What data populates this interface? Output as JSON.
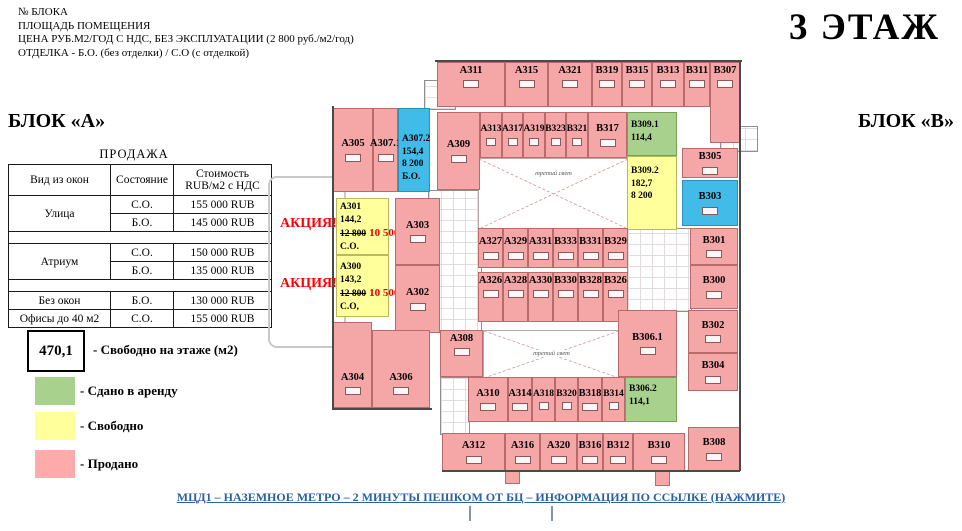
{
  "doc_header": {
    "lines": [
      "№ БЛОКА",
      "ПЛОЩАДЬ ПОМЕЩЕНИЯ",
      "ЦЕНА РУБ.М2/ГОД С НДС, БЕЗ ЭКСПЛУАТАЦИИ (2 800 руб./м2/год)",
      "ОТДЕЛКА - Б.О. (без отделки) / С.О (с отделкой)"
    ]
  },
  "floor_title": "3 ЭТАЖ",
  "block_labels": {
    "a": "БЛОК «А»",
    "b": "БЛОК «В»"
  },
  "sales_table": {
    "title": "ПРОДАЖА",
    "columns": [
      "Вид из окон",
      "Состояние",
      "Стоимость\nRUB/м2 с НДС"
    ],
    "groups": [
      {
        "name": "Улица",
        "rows": [
          [
            "С.О.",
            "155 000 RUB"
          ],
          [
            "Б.О.",
            "145 000 RUB"
          ]
        ],
        "spacer_after": true
      },
      {
        "name": "Атриум",
        "rows": [
          [
            "С.О.",
            "150 000 RUB"
          ],
          [
            "Б.О.",
            "135 000 RUB"
          ]
        ],
        "spacer_after": true
      },
      {
        "name": "Без окон",
        "rows": [
          [
            "Б.О.",
            "130 000 RUB"
          ]
        ],
        "spacer_after": false
      },
      {
        "name": "Офисы до 40 м2",
        "rows": [
          [
            "С.О.",
            "155 000 RUB"
          ]
        ],
        "spacer_after": false
      }
    ]
  },
  "legend": {
    "free_area_box": {
      "value": "470,1",
      "label": "- Свободно на этаже (м2)"
    },
    "items": [
      {
        "key": "leased",
        "color": "#A9D18E",
        "label": "- Сдано в аренду"
      },
      {
        "key": "free",
        "color": "#FFFF9C",
        "label": "- Свободно"
      },
      {
        "key": "sold",
        "color": "#FFABAB",
        "label": "- Продано"
      }
    ]
  },
  "promo_labels": [
    {
      "text": "АКЦИЯ!",
      "x": 280,
      "y": 216
    },
    {
      "text": "АКЦИЯ!",
      "x": 280,
      "y": 276
    }
  ],
  "colors": {
    "sold": {
      "fill": "#F5A6A6",
      "border": "#B96A6A"
    },
    "free": {
      "fill": "#FFFF9C",
      "border": "#B9B95E"
    },
    "leased": {
      "fill": "#A9D18E",
      "border": "#74A356"
    },
    "special": {
      "fill": "#41BCE8",
      "border": "#2E8FB5"
    }
  },
  "plan": {
    "atrium_label": "третий свет",
    "atriums": [
      {
        "r": [
          478,
          158,
          149,
          70
        ],
        "label_pos": 0.16
      },
      {
        "r": [
          483,
          330,
          135,
          47
        ],
        "label_pos": 0.4
      }
    ],
    "cores": [
      [
        428,
        190,
        52,
        140
      ],
      [
        440,
        377,
        28,
        56
      ],
      [
        627,
        228,
        63,
        82
      ],
      [
        720,
        126,
        36,
        24
      ],
      [
        424,
        80,
        30,
        28
      ]
    ],
    "stubs": [
      [
        505,
        470,
        13,
        12
      ],
      [
        655,
        470,
        13,
        14
      ]
    ],
    "rooms": [
      {
        "id": "А311",
        "s": "sold",
        "r": [
          437,
          62,
          68,
          45
        ],
        "va": "top"
      },
      {
        "id": "А315",
        "s": "sold",
        "r": [
          505,
          62,
          43,
          45
        ],
        "va": "top"
      },
      {
        "id": "А321",
        "s": "sold",
        "r": [
          548,
          62,
          44,
          45
        ],
        "va": "top"
      },
      {
        "id": "В319",
        "s": "sold",
        "r": [
          592,
          62,
          30,
          45
        ],
        "va": "top"
      },
      {
        "id": "В315",
        "s": "sold",
        "r": [
          622,
          62,
          30,
          45
        ],
        "va": "top"
      },
      {
        "id": "В313",
        "s": "sold",
        "r": [
          652,
          62,
          32,
          45
        ],
        "va": "top"
      },
      {
        "id": "В311",
        "s": "sold",
        "r": [
          684,
          62,
          26,
          45
        ],
        "va": "top"
      },
      {
        "id": "В307",
        "s": "sold",
        "r": [
          710,
          62,
          30,
          81
        ],
        "va": "top"
      },
      {
        "id": "А305",
        "s": "sold",
        "r": [
          333,
          108,
          40,
          84
        ]
      },
      {
        "id": "А307.1",
        "s": "sold",
        "r": [
          373,
          108,
          25,
          84
        ]
      },
      {
        "id": "А307.2",
        "s": "special",
        "r": [
          398,
          108,
          32,
          84
        ],
        "lines": [
          "А307.2",
          "154,4",
          "8 200",
          "Б.О."
        ],
        "pt": 24
      },
      {
        "id": "А309",
        "s": "sold",
        "r": [
          437,
          112,
          43,
          78
        ]
      },
      {
        "id": "А313",
        "s": "sold",
        "r": [
          480,
          112,
          22,
          46
        ]
      },
      {
        "id": "А317",
        "s": "sold",
        "r": [
          502,
          112,
          21,
          46
        ]
      },
      {
        "id": "А319",
        "s": "sold",
        "r": [
          523,
          112,
          22,
          46
        ]
      },
      {
        "id": "В323",
        "s": "sold",
        "r": [
          545,
          112,
          21,
          46
        ]
      },
      {
        "id": "В321",
        "s": "sold",
        "r": [
          566,
          112,
          22,
          46
        ]
      },
      {
        "id": "В317",
        "s": "sold",
        "r": [
          588,
          112,
          39,
          46
        ]
      },
      {
        "id": "В309.1",
        "s": "leased",
        "r": [
          627,
          112,
          50,
          44
        ],
        "lines": [
          "В309.1",
          "114,4"
        ],
        "pt": 6
      },
      {
        "id": "В309.2",
        "s": "free",
        "r": [
          627,
          156,
          50,
          74
        ],
        "lines": [
          "В309.2",
          "182,7",
          "8 200"
        ],
        "pt": 8
      },
      {
        "id": "А301",
        "s": "free",
        "r": [
          336,
          198,
          53,
          57
        ],
        "lines": [
          "А301",
          "144,2",
          {
            "old": "12 800",
            "new": "10 500"
          },
          "С.О."
        ],
        "pt": 2
      },
      {
        "id": "А300",
        "s": "free",
        "r": [
          336,
          255,
          53,
          62
        ],
        "lines": [
          "А300",
          "143,2",
          {
            "old": "12 800",
            "new": "10 500"
          },
          "С.О,"
        ],
        "pt": 5
      },
      {
        "id": "А303",
        "s": "sold",
        "r": [
          395,
          198,
          45,
          67
        ]
      },
      {
        "id": "А302",
        "s": "sold",
        "r": [
          395,
          265,
          45,
          68
        ]
      },
      {
        "id": "А304",
        "s": "sold",
        "r": [
          333,
          322,
          39,
          86
        ],
        "va": "bottom"
      },
      {
        "id": "А306",
        "s": "sold",
        "r": [
          372,
          330,
          58,
          78
        ],
        "va": "bottom"
      },
      {
        "id": "А308",
        "s": "sold",
        "r": [
          440,
          330,
          43,
          47
        ],
        "va": "top"
      },
      {
        "id": "А327",
        "s": "sold",
        "r": [
          478,
          228,
          25,
          40
        ]
      },
      {
        "id": "А329",
        "s": "sold",
        "r": [
          503,
          228,
          25,
          40
        ]
      },
      {
        "id": "А331",
        "s": "sold",
        "r": [
          528,
          228,
          25,
          40
        ]
      },
      {
        "id": "В333",
        "s": "sold",
        "r": [
          553,
          228,
          25,
          40
        ]
      },
      {
        "id": "В331",
        "s": "sold",
        "r": [
          578,
          228,
          25,
          40
        ]
      },
      {
        "id": "В329",
        "s": "sold",
        "r": [
          603,
          228,
          25,
          40
        ]
      },
      {
        "id": "А326",
        "s": "sold",
        "r": [
          478,
          272,
          25,
          50
        ],
        "va": "top"
      },
      {
        "id": "А328",
        "s": "sold",
        "r": [
          503,
          272,
          25,
          50
        ],
        "va": "top"
      },
      {
        "id": "А330",
        "s": "sold",
        "r": [
          528,
          272,
          25,
          50
        ],
        "va": "top"
      },
      {
        "id": "В330",
        "s": "sold",
        "r": [
          553,
          272,
          25,
          50
        ],
        "va": "top"
      },
      {
        "id": "В328",
        "s": "sold",
        "r": [
          578,
          272,
          25,
          50
        ],
        "va": "top"
      },
      {
        "id": "В326",
        "s": "sold",
        "r": [
          603,
          272,
          25,
          50
        ],
        "va": "top"
      },
      {
        "id": "А310",
        "s": "sold",
        "r": [
          468,
          377,
          40,
          45
        ]
      },
      {
        "id": "А314",
        "s": "sold",
        "r": [
          508,
          377,
          24,
          45
        ]
      },
      {
        "id": "А318",
        "s": "sold",
        "r": [
          532,
          377,
          23,
          45
        ]
      },
      {
        "id": "В320",
        "s": "sold",
        "r": [
          555,
          377,
          23,
          45
        ]
      },
      {
        "id": "В318",
        "s": "sold",
        "r": [
          578,
          377,
          24,
          45
        ]
      },
      {
        "id": "В314",
        "s": "sold",
        "r": [
          602,
          377,
          23,
          45
        ]
      },
      {
        "id": "В306.2",
        "s": "leased",
        "r": [
          625,
          377,
          52,
          45
        ],
        "lines": [
          "В306.2",
          "114,1"
        ],
        "pt": 5
      },
      {
        "id": "А312",
        "s": "sold",
        "r": [
          442,
          433,
          63,
          38
        ]
      },
      {
        "id": "А316",
        "s": "sold",
        "r": [
          505,
          433,
          35,
          38
        ]
      },
      {
        "id": "А320",
        "s": "sold",
        "r": [
          540,
          433,
          37,
          38
        ]
      },
      {
        "id": "В316",
        "s": "sold",
        "r": [
          577,
          433,
          26,
          38
        ]
      },
      {
        "id": "В312",
        "s": "sold",
        "r": [
          603,
          433,
          30,
          38
        ]
      },
      {
        "id": "В310",
        "s": "sold",
        "r": [
          633,
          433,
          52,
          38
        ]
      },
      {
        "id": "В308",
        "s": "sold",
        "r": [
          688,
          427,
          52,
          44
        ]
      },
      {
        "id": "В305",
        "s": "sold",
        "r": [
          682,
          148,
          56,
          30
        ]
      },
      {
        "id": "В303",
        "s": "special",
        "r": [
          682,
          180,
          56,
          46
        ]
      },
      {
        "id": "В301",
        "s": "sold",
        "r": [
          690,
          228,
          48,
          37
        ]
      },
      {
        "id": "В300",
        "s": "sold",
        "r": [
          690,
          265,
          48,
          44
        ]
      },
      {
        "id": "В302",
        "s": "sold",
        "r": [
          688,
          310,
          50,
          43
        ]
      },
      {
        "id": "В304",
        "s": "sold",
        "r": [
          688,
          353,
          50,
          38
        ]
      },
      {
        "id": "В306.1",
        "s": "sold",
        "r": [
          618,
          310,
          59,
          67
        ]
      }
    ]
  },
  "footer": {
    "link": "МЦД1 – НАЗЕМНОЕ МЕТРО – 2 МИНУТЫ ПЕШКОМ ОТ БЦ – ИНФОРМАЦИЯ ПО ССЫЛКЕ (НАЖМИТЕ)"
  }
}
